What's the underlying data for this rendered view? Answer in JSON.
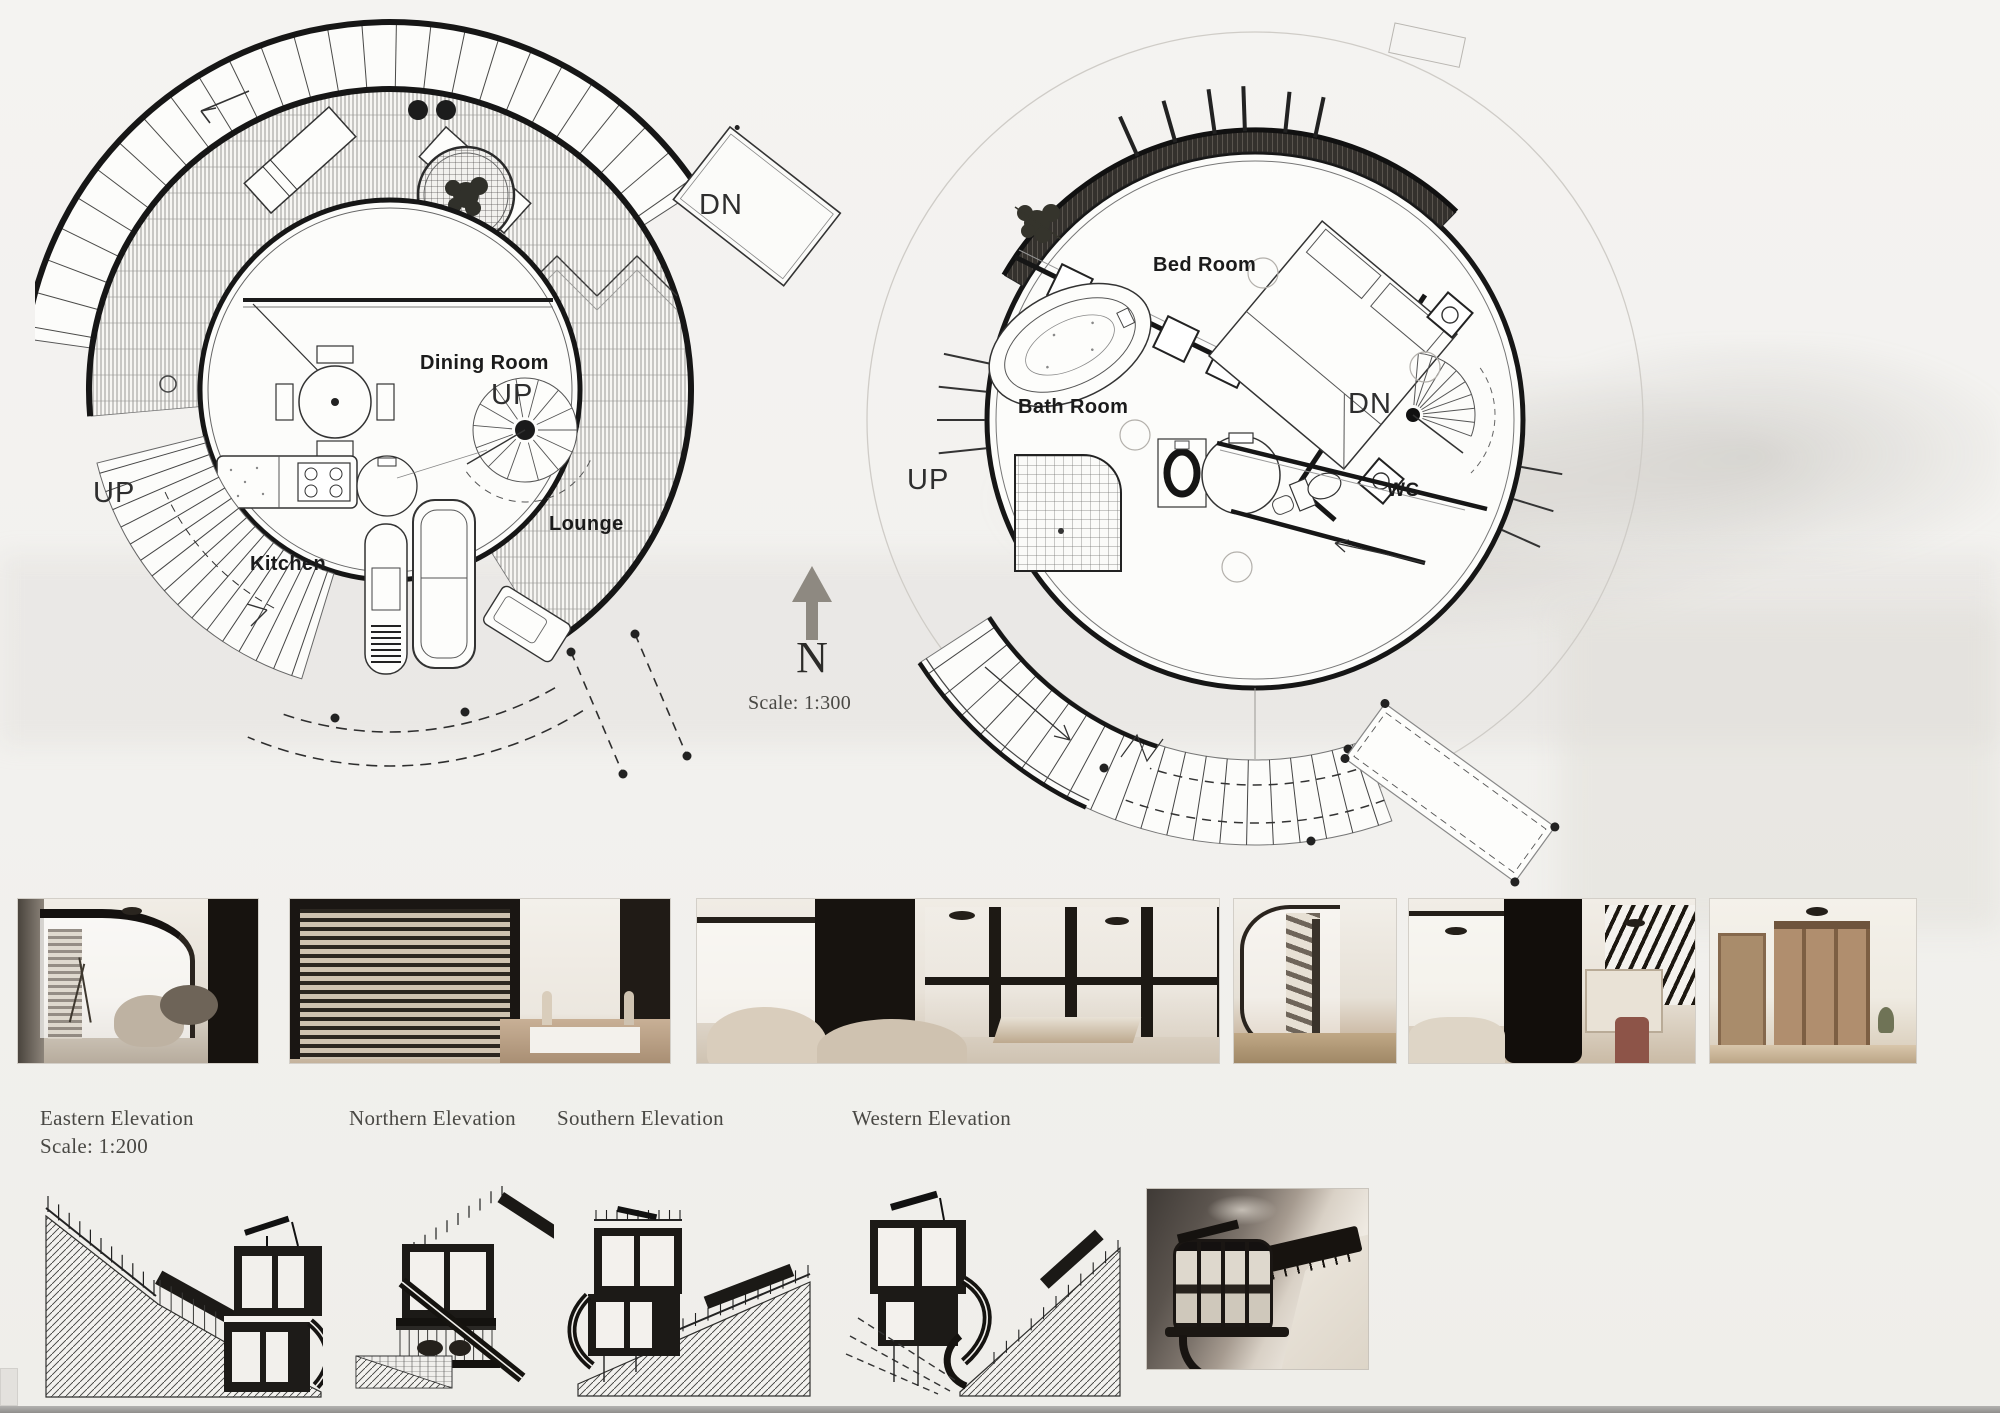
{
  "compass": {
    "north_letter": "N",
    "scale_note": "Scale: 1:300"
  },
  "plan_ground": {
    "rooms": {
      "dining": "Dining Room",
      "kitchen": "Kitchen",
      "lounge": "Lounge"
    },
    "stairs": {
      "up_outer": "UP",
      "up_spiral": "UP",
      "dn_deck": "DN"
    }
  },
  "plan_upper": {
    "rooms": {
      "bed": "Bed Room",
      "bath": "Bath Room",
      "wc": "WC"
    },
    "stairs": {
      "dn_spiral": "DN",
      "up_outer": "UP"
    }
  },
  "elevation_labels": {
    "eastern": "Eastern Elevation",
    "eastern_scale": "Scale: 1:200",
    "northern": "Northern Elevation",
    "southern": "Southern Elevation",
    "western": "Western Elevation"
  },
  "thumbnails": [
    {
      "name": "bathroom-interior-render"
    },
    {
      "name": "bedroom-blinds-interior-render"
    },
    {
      "name": "lounge-balcony-interior-render"
    },
    {
      "name": "spiral-stair-interior-render"
    },
    {
      "name": "bedroom-stair-interior-render"
    },
    {
      "name": "wardrobe-hallway-interior-render"
    }
  ],
  "colors": {
    "paper": "#f2f1ee",
    "ink": "#1b1b1b",
    "north_arrow": "#8e8981",
    "render_sepia": "#6b645e",
    "wood_tan": "#b08e6e"
  }
}
